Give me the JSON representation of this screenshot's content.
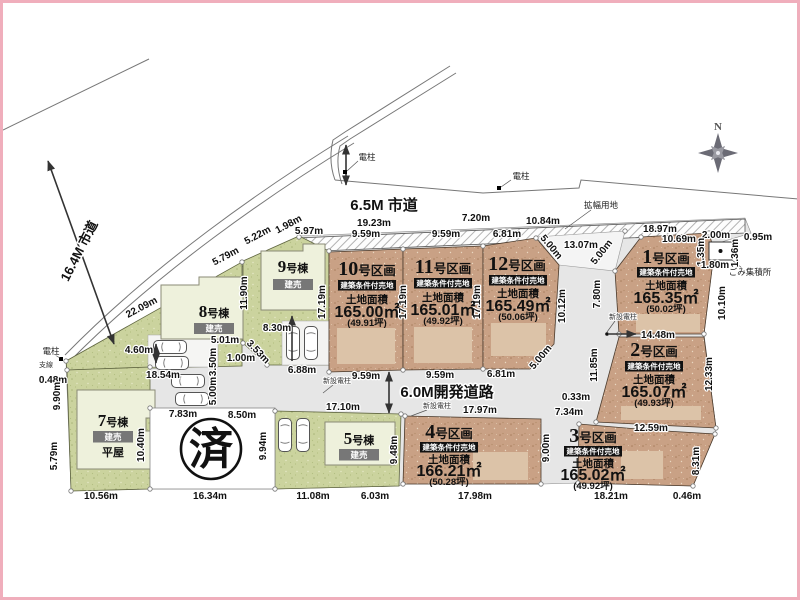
{
  "compass": {
    "north": "N"
  },
  "roads": {
    "shido65": "6.5M 市道",
    "shido164": "16.4M 市道",
    "kaihatsu": "6.0M開発道路"
  },
  "annotations": {
    "kakufuku_yochi": "拡幅用地",
    "gomi_shukeisho": "ごみ集積所",
    "denchu": "電柱",
    "shisen": "支線",
    "shinsetsu_denchu": "新設電柱",
    "sold_mark": "済"
  },
  "badges": {
    "joken_baichi": "建築条件付売地",
    "tateuri": "建売",
    "tochi_menseki": "土地面積",
    "hiraya": "平屋"
  },
  "lots": [
    {
      "num": "1",
      "suffix": "号区画",
      "area": "165.35㎡",
      "tsubo": "(50.02坪)"
    },
    {
      "num": "2",
      "suffix": "号区画",
      "area": "165.07㎡",
      "tsubo": "(49.93坪)"
    },
    {
      "num": "3",
      "suffix": "号区画",
      "area": "165.02㎡",
      "tsubo": "(49.92坪)"
    },
    {
      "num": "4",
      "suffix": "号区画",
      "area": "166.21㎡",
      "tsubo": "(50.28坪)"
    },
    {
      "num": "10",
      "suffix": "号区画",
      "area": "165.00㎡",
      "tsubo": "(49.91坪)"
    },
    {
      "num": "11",
      "suffix": "号区画",
      "area": "165.01㎡",
      "tsubo": "(49.92坪)"
    },
    {
      "num": "12",
      "suffix": "号区画",
      "area": "165.49㎡",
      "tsubo": "(50.06坪)"
    }
  ],
  "buildings": [
    {
      "num": "5",
      "suffix": "号棟"
    },
    {
      "num": "7",
      "suffix": "号棟"
    },
    {
      "num": "8",
      "suffix": "号棟"
    },
    {
      "num": "9",
      "suffix": "号棟"
    }
  ],
  "dims": [
    "19.23m",
    "9.59m",
    "7.20m",
    "9.59m",
    "6.81m",
    "10.84m",
    "13.07m",
    "18.97m",
    "10.69m",
    "2.00m",
    "0.95m",
    "5.97m",
    "1.98m",
    "5.22m",
    "5.79m",
    "22.09m",
    "0.48m",
    "4.60m",
    "18.54m",
    "9.90m",
    "5.79m",
    "10.56m",
    "7.83m",
    "8.50m",
    "10.40m",
    "16.34m",
    "9.94m",
    "11.08m",
    "6.03m",
    "9.48m",
    "17.10m",
    "5.01m",
    "3.50m",
    "1.00m",
    "3.53m",
    "5.00m",
    "8.30m",
    "6.88m",
    "11.90m",
    "17.19m",
    "17.19m",
    "17.19m",
    "9.59m",
    "9.59m",
    "6.81m",
    "17.97m",
    "17.98m",
    "9.00m",
    "7.34m",
    "0.33m",
    "12.59m",
    "18.21m",
    "0.46m",
    "8.31m",
    "12.33m",
    "11.85m",
    "10.12m",
    "5.00m",
    "5.00m",
    "5.00m",
    "14.48m",
    "7.80m",
    "10.10m",
    "1.35m",
    "1.80m",
    "1.36m"
  ]
}
